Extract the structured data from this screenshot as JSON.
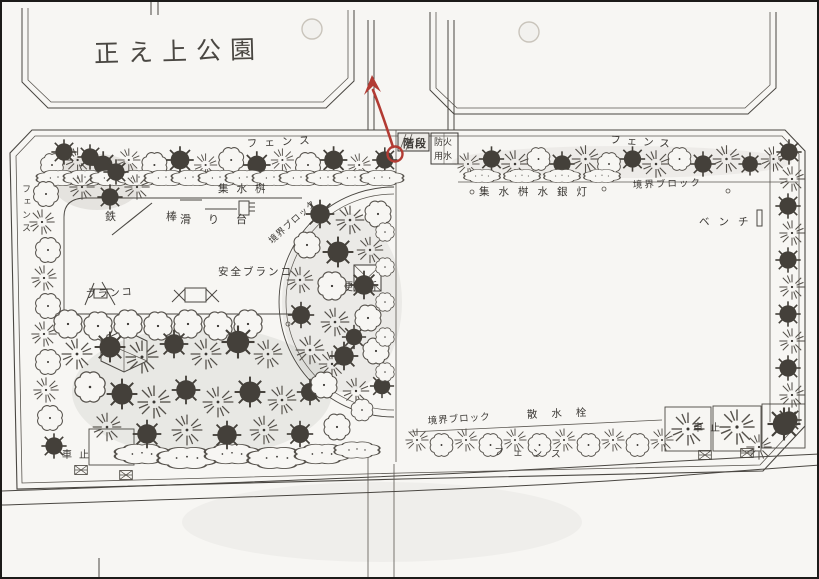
{
  "page": {
    "title": "正え上公園",
    "type": "scanned park site plan"
  },
  "plan": {
    "labels": {
      "fence_top_left": "フェンス",
      "fence_top_right": "フェンス",
      "fence_left": "フェンス",
      "fence_bottom": "フェンス",
      "catch_basin": "集水桝",
      "catch_basin_lamp": "集水桝水銀灯",
      "boundary_block_top": "境界ブロック",
      "boundary_block_arc": "境界ブロック",
      "boundary_block_bottom": "境界ブロック",
      "iron_bar": "鉄棒",
      "slide": "滑り台",
      "swing": "ブランコ",
      "safety_swing": "安全ブランコ",
      "toilet": "便所",
      "stairs": "階段",
      "fire_water_row1": "防火",
      "fire_water_row2": "用水",
      "bench": "ベンチ",
      "sprinkler": "散水栓",
      "car_stop_left": "車止",
      "car_stop_right": "車止"
    },
    "annotation": {
      "type": "red-pen-circle-and-arrow",
      "color": "#b23b33",
      "points_to": "階段 (entrance stairs)"
    },
    "colors": {
      "ink": "#3b3834",
      "paper": "#f7f6f3",
      "annotation_red": "#b23b33"
    }
  }
}
